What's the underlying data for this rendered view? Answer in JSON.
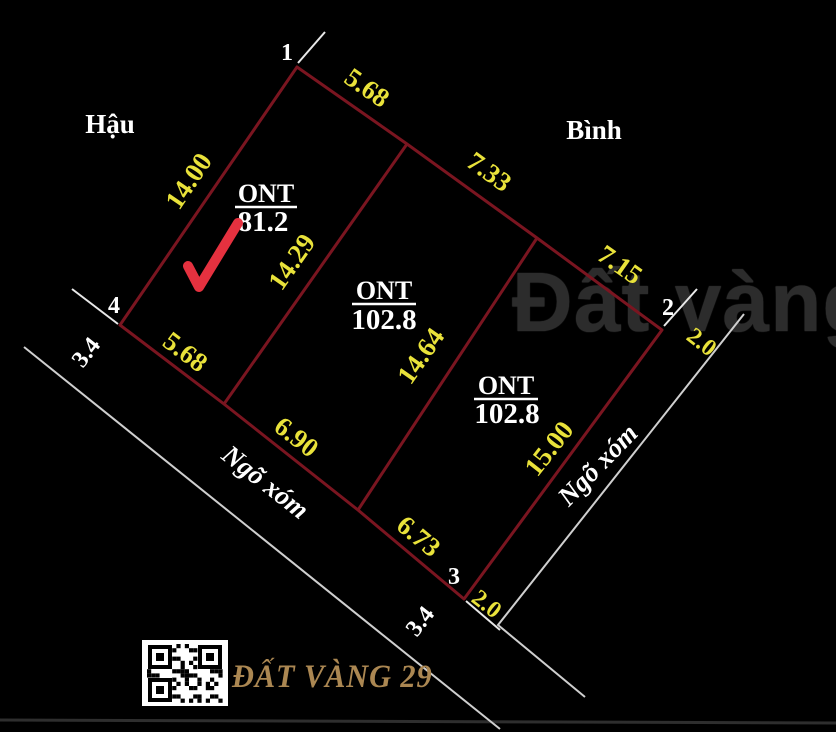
{
  "title": "Land parcel subdivision sketch",
  "neighbors": {
    "left": "Hậu",
    "right": "Bình"
  },
  "roads": {
    "left": "Ngõ xóm",
    "right": "Ngõ xóm"
  },
  "vertices": {
    "v1": "1",
    "v2": "2",
    "v3": "3",
    "v4": "4"
  },
  "parcels": [
    {
      "land_use": "ONT",
      "area": "81.2"
    },
    {
      "land_use": "ONT",
      "area": "102.8"
    },
    {
      "land_use": "ONT",
      "area": "102.8"
    }
  ],
  "dimensions": {
    "top_a": "5.68",
    "top_b": "7.33",
    "top_c": "7.15",
    "left": "14.00",
    "divider_1": "14.29",
    "divider_2": "14.64",
    "right": "15.00",
    "bottom_a": "5.68",
    "bottom_b": "6.90",
    "bottom_c": "6.73",
    "offset_v2": "2.0",
    "offset_v3": "2.0",
    "road_width_left": "3.4",
    "road_width_bottom": "3.4"
  },
  "annotations": {
    "checkmark": "red-checkmark-on-parcel-1"
  },
  "watermark": "Đất vàng 29",
  "branding": {
    "name": "ĐẤT VÀNG 29",
    "qr": "qr-code"
  },
  "colors": {
    "background": "#000000",
    "boundary_red": "#7a1520",
    "dimension_yellow": "#e9e23a",
    "label_white": "#ffffff",
    "checkmark_red": "#e5313f",
    "brand_gold": "#ab8752",
    "watermark_gray": "#2c2c2c"
  }
}
